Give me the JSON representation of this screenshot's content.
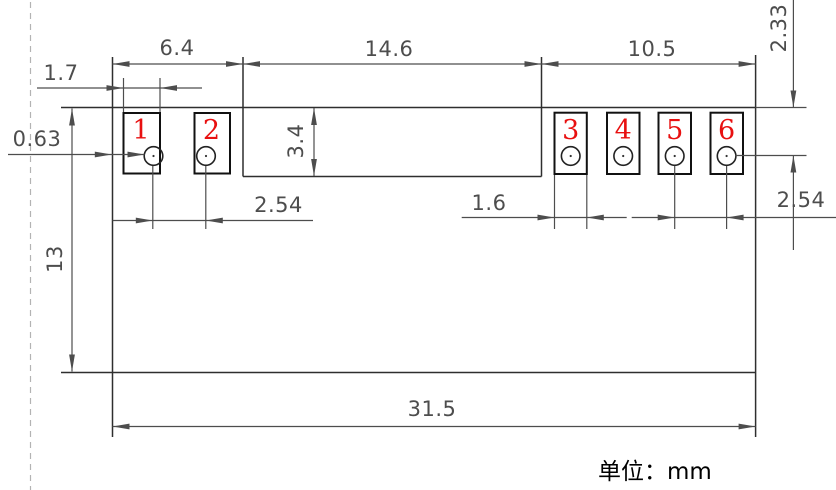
{
  "drawing": {
    "type": "component-footprint-dimension-drawing",
    "unit_label": "单位：mm",
    "pads": {
      "labels": [
        "1",
        "2",
        "3",
        "4",
        "5",
        "6"
      ]
    },
    "dimensions": {
      "left_edge_to_slot": "6.4",
      "slot_width": "14.6",
      "slot_to_right_edge": "10.5",
      "pad1_width": "1.7",
      "edge_to_pad1_gap": "0.63",
      "slot_height": "3.4",
      "body_height": "13",
      "pads12_hole_pitch": "2.54",
      "pad3_width": "1.6",
      "pads56_hole_pitch": "2.54",
      "top_edge_to_hole_row": "2.33",
      "body_width": "31.5"
    },
    "colors": {
      "outline": "#2e2e2e",
      "pad_stroke": "#111111",
      "dimension": "#4d4d4d",
      "pad_number": "#e81010",
      "centerline": "#b3b3b3",
      "background": "#ffffff"
    }
  }
}
